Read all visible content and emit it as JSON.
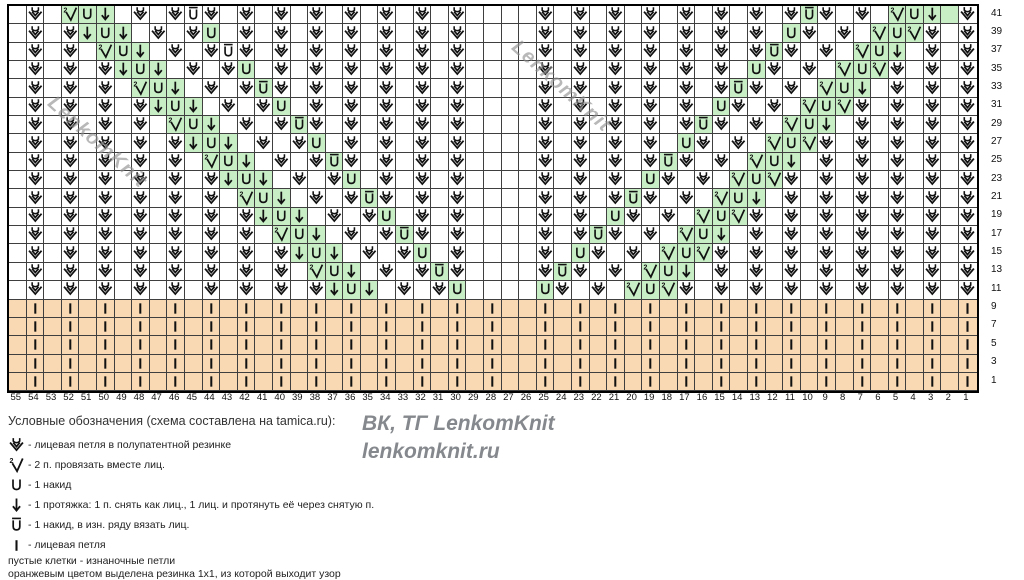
{
  "watermark": {
    "diagonal": "LenkomKnit",
    "center_line1": "ВК, ТГ LenkomKnit",
    "center_line2": "lenkomknit.ru"
  },
  "colors": {
    "green": "#c8eec6",
    "orange": "#f8d9b4",
    "grid_line": "#3f3f3f",
    "symbol": "#111111"
  },
  "legend": {
    "title": "Условные обозначения (схема составлена на tamica.ru):",
    "items": [
      {
        "sym": "V",
        "icon": "brioche-knit-icon",
        "text": "-  лицевая петля в полупатентной резинке"
      },
      {
        "sym": "2",
        "icon": "k2tog-icon",
        "text": "- 2 п. провязать вместе лиц."
      },
      {
        "sym": "U",
        "icon": "yarnover-icon",
        "text": "- 1 накид"
      },
      {
        "sym": "D",
        "icon": "slip-pass-over-icon",
        "text": "- 1 протяжка: 1 п. снять как лиц., 1 лиц. и протянуть её через снятую п."
      },
      {
        "sym": "B",
        "icon": "yarnover-knit-ws-icon",
        "text": "- 1 накид, в изн. ряду вязать лиц."
      },
      {
        "sym": "|",
        "icon": "knit-stitch-icon",
        "text": "- лицевая петля"
      }
    ],
    "notes": [
      "пустые клетки - изнаночные петли",
      "оранжевым цветом выделена резинка 1х1, из которой выходит узор"
    ]
  },
  "chart": {
    "col_labels": [
      55,
      54,
      53,
      52,
      51,
      50,
      49,
      48,
      47,
      46,
      45,
      44,
      43,
      42,
      41,
      40,
      39,
      38,
      37,
      36,
      35,
      34,
      33,
      32,
      31,
      30,
      29,
      28,
      27,
      26,
      25,
      24,
      23,
      22,
      21,
      20,
      19,
      18,
      17,
      16,
      15,
      14,
      13,
      12,
      11,
      10,
      9,
      8,
      7,
      6,
      5,
      4,
      3,
      2,
      1
    ],
    "symbol_key": {
      "V": "brioche knit stitch",
      "2": "knit 2 together",
      "U": "yarnover",
      "D": "slip 1, knit 1, pass slipped over",
      "B": "yarnover, knit on wrong-side row",
      "|": "knit stitch",
      ".": "purl (empty cell)"
    },
    "rows": [
      {
        "label": "41",
        "cells": ".V.2UD.V.VBV.V.V.V.V.V.V.V....V.V.V.V.V.V.V.VBV.V.2UD.V",
        "green": [
          3,
          4,
          5,
          45,
          50,
          51,
          52,
          53
        ]
      },
      {
        "label": "39",
        "cells": ".V.VDUD.V.VU.V.V.V.V.V.V.V....V.V.V.V.V.V.V.UV.V.2U2V.V",
        "green": [
          4,
          5,
          6,
          11,
          44,
          49,
          50,
          51
        ]
      },
      {
        "label": "37",
        "cells": ".V.V.2UD.V.VBV.V.V.V.V.V.V....V.V.V.V.V.V.VBV.V.2UD.V.V",
        "green": [
          5,
          6,
          7,
          43,
          48,
          49,
          50
        ]
      },
      {
        "label": "35",
        "cells": ".V.V.VDUD.V.VU.V.V.V.V.V.V....V.V.V.V.V.V.UV.V.2U2V.V.V",
        "green": [
          6,
          7,
          8,
          13,
          42,
          47,
          48,
          49
        ]
      },
      {
        "label": "33",
        "cells": ".V.V.V.2UD.V.VBV.V.V.V.V.V....V.V.V.V.V.VBV.V.2UD.V.V.V",
        "green": [
          7,
          8,
          9,
          14,
          41,
          46,
          47,
          48
        ]
      },
      {
        "label": "31",
        "cells": ".V.V.V.VDUD.V.VU.V.V.V.V.V....V.V.V.V.V.UV.V.2U2V.V.V.V",
        "green": [
          8,
          9,
          10,
          15,
          40,
          45,
          46,
          47
        ]
      },
      {
        "label": "29",
        "cells": ".V.V.V.V.2UD.V.VBV.V.V.V.V....V.V.V.V.VBV.V.2UD.V.V.V.V",
        "green": [
          9,
          10,
          11,
          16,
          39,
          44,
          45,
          46
        ]
      },
      {
        "label": "27",
        "cells": ".V.V.V.V.VDUD.V.VU.V.V.V.V....V.V.V.V.UV.V.2U2V.V.V.V.V",
        "green": [
          10,
          11,
          12,
          17,
          38,
          43,
          44,
          45
        ]
      },
      {
        "label": "25",
        "cells": ".V.V.V.V.V.2UD.V.VBV.V.V.V....V.V.V.VBV.V.2UD.V.V.V.V.V",
        "green": [
          11,
          12,
          13,
          18,
          37,
          42,
          43,
          44
        ]
      },
      {
        "label": "23",
        "cells": ".V.V.V.V.V.VDUD.V.VU.V.V.V....V.V.V.UV.V.2U2V.V.V.V.V.V",
        "green": [
          12,
          13,
          14,
          19,
          36,
          41,
          42,
          43
        ]
      },
      {
        "label": "21",
        "cells": ".V.V.V.V.V.V.2UD.V.VBV.V.V....V.V.VBV.V.2UD.V.V.V.V.V.V",
        "green": [
          13,
          14,
          15,
          20,
          35,
          40,
          41,
          42
        ]
      },
      {
        "label": "19",
        "cells": ".V.V.V.V.V.V.VDUD.V.VU.V.V....V.V.UV.V.2U2V.V.V.V.V.V.V",
        "green": [
          14,
          15,
          16,
          21,
          34,
          39,
          40,
          41
        ]
      },
      {
        "label": "17",
        "cells": ".V.V.V.V.V.V.V.2UD.V.VBV.V....V.VBV.V.2UD.V.V.V.V.V.V.V",
        "green": [
          15,
          16,
          17,
          22,
          33,
          38,
          39,
          40
        ]
      },
      {
        "label": "15",
        "cells": ".V.V.V.V.V.V.V.VDUD.V.VU.V....V.UV.V.2U2V.V.V.V.V.V.V.V",
        "green": [
          16,
          17,
          18,
          23,
          32,
          37,
          38,
          39
        ]
      },
      {
        "label": "13",
        "cells": ".V.V.V.V.V.V.V.V.2UD.V.VBV....VBV.V.2UD.V.V.V.V.V.V.V.V",
        "green": [
          17,
          18,
          19,
          24,
          31,
          36,
          37,
          38
        ]
      },
      {
        "label": "11",
        "cells": ".V.V.V.V.V.V.V.V.VDUD.V.VU....UV.V.2U2V.V.V.V.V.V.V.V.V",
        "green": [
          18,
          19,
          20,
          25,
          30,
          35,
          36,
          37
        ]
      },
      {
        "label": "9",
        "orange": true,
        "cells": ".|.|.|.|.|.|.|.|.|.|.|.|.|.|..|.|.|.|.|.|.|.|.|.|.|.|.|"
      },
      {
        "label": "7",
        "orange": true,
        "cells": ".|.|.|.|.|.|.|.|.|.|.|.|.|.|..|.|.|.|.|.|.|.|.|.|.|.|.|"
      },
      {
        "label": "5",
        "orange": true,
        "cells": ".|.|.|.|.|.|.|.|.|.|.|.|.|.|..|.|.|.|.|.|.|.|.|.|.|.|.|"
      },
      {
        "label": "3",
        "orange": true,
        "cells": ".|.|.|.|.|.|.|.|.|.|.|.|.|.|..|.|.|.|.|.|.|.|.|.|.|.|.|"
      },
      {
        "label": "1",
        "orange": true,
        "cells": ".|.|.|.|.|.|.|.|.|.|.|.|.|.|..|.|.|.|.|.|.|.|.|.|.|.|.|"
      }
    ]
  }
}
